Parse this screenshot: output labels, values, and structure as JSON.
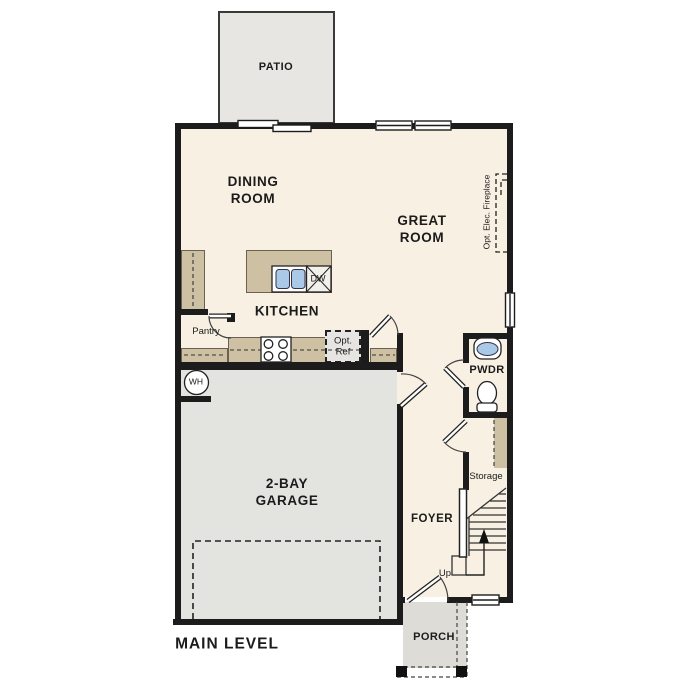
{
  "plan": {
    "level_label": "MAIN LEVEL",
    "rooms": {
      "patio": "PATIO",
      "dining": {
        "line1": "DINING",
        "line2": "ROOM"
      },
      "great": {
        "line1": "GREAT",
        "line2": "ROOM"
      },
      "kitchen": "KITCHEN",
      "garage": {
        "line1": "2-BAY",
        "line2": "GARAGE"
      },
      "foyer": "FOYER",
      "pwdr": "PWDR",
      "porch": "PORCH",
      "storage": "Storage",
      "pantry": "Pantry"
    },
    "annotations": {
      "fireplace": "Opt. Elec. Fireplace",
      "opt_ref": {
        "line1": "Opt.",
        "line2": "Ref"
      },
      "dishwasher": "DW",
      "water_heater": "WH",
      "stairs_up": "Up"
    },
    "colors": {
      "wall": "#1c1c1c",
      "floor": "#f8f0e2",
      "garage_floor": "#e3e3e0",
      "patio_floor": "#e7e6e3",
      "porch_floor": "#dddcd7",
      "counter": "#cec0a3",
      "fixture_blue": "#aac8e8"
    }
  }
}
